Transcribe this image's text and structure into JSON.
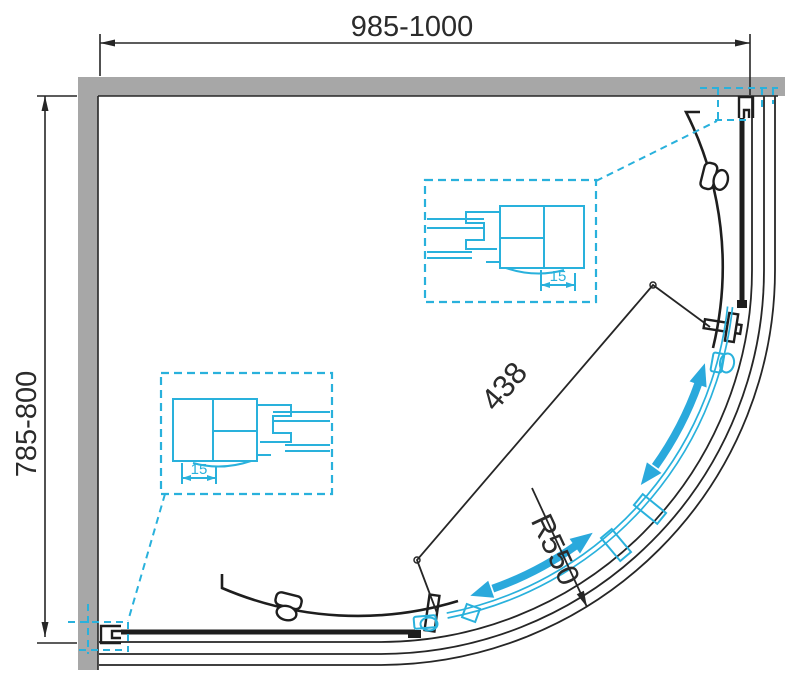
{
  "drawing": {
    "title": "quadrant-shower-enclosure-plan",
    "dimensions": {
      "width_range": "985-1000",
      "depth_range": "785-800",
      "door_chord": "438",
      "radius": "R550",
      "profile_adjust_top": "15",
      "profile_adjust_bottom": "15"
    },
    "colors": {
      "wall_gray": "#a7a7a7",
      "line_black": "#262626",
      "accent_cyan": "#29b1dc",
      "arrow_blue": "#2aa9dc",
      "text_dark": "#2b2b2b"
    },
    "icons": {
      "slide_direction_upper": "double-headed-curved-arrow",
      "slide_direction_lower": "double-headed-curved-arrow"
    }
  }
}
